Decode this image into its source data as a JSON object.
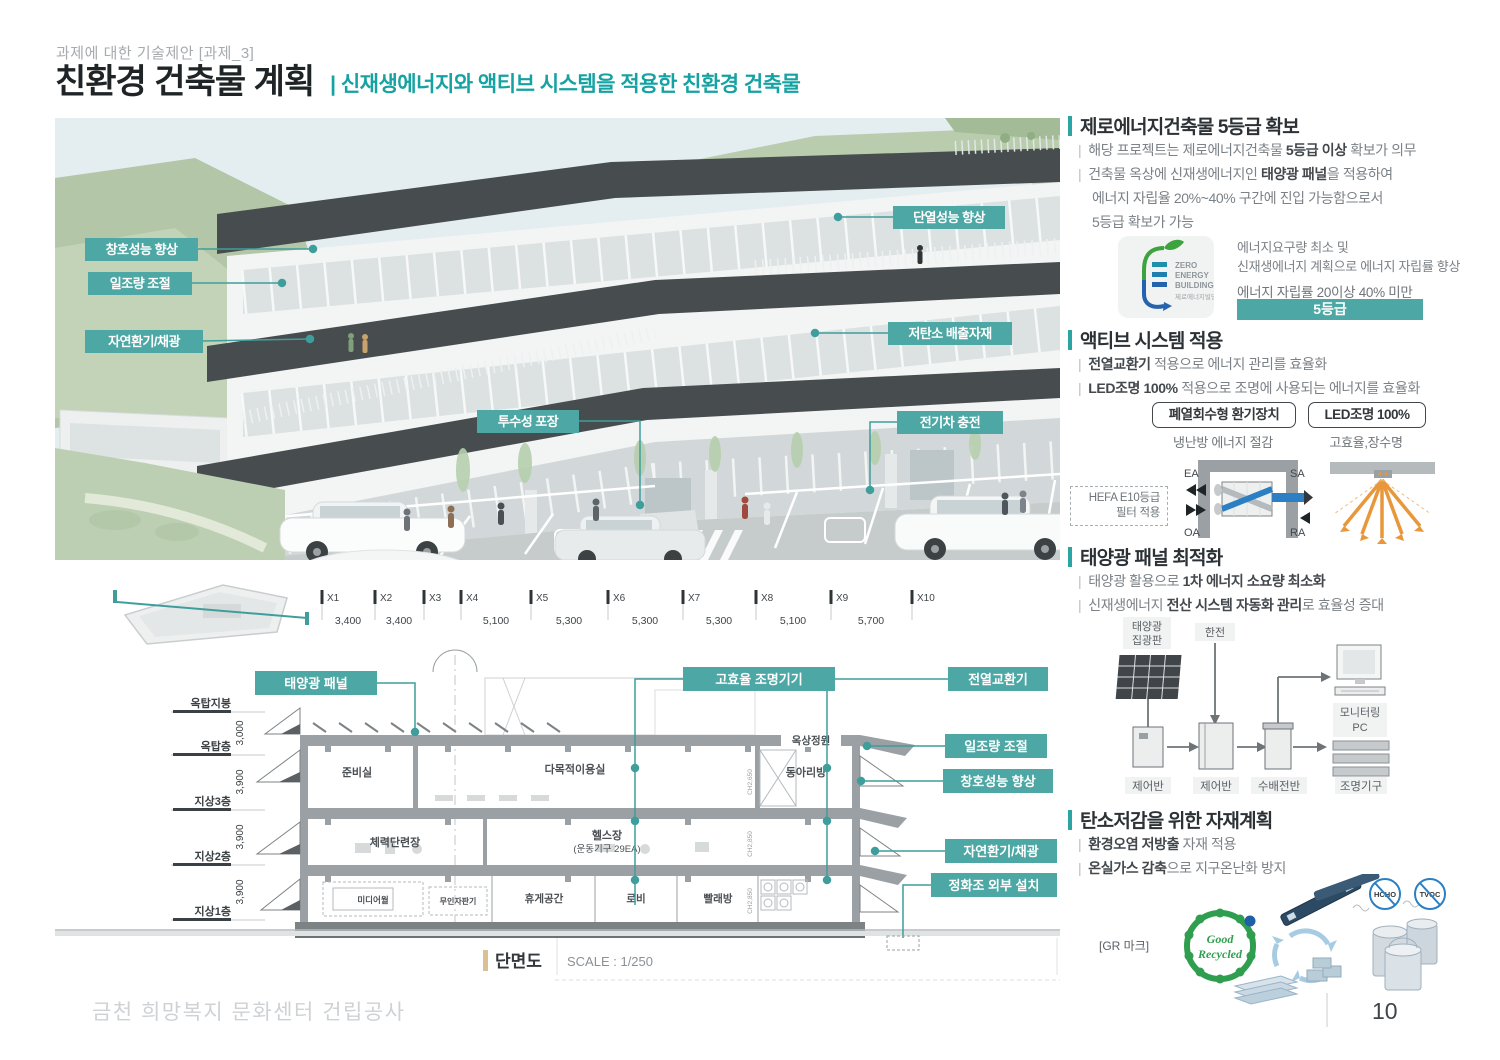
{
  "colors": {
    "accent": "#2ba5a3",
    "callout_fill": "#4da7a4",
    "roof_band": "#474c4f",
    "orange": "#e8973a",
    "blue_pipe": "#2b7fc2",
    "green_seal": "#2f9e4f"
  },
  "header": {
    "eyebrow": "과제에 대한 기술제안 [과제_3]",
    "title": "친환경 건축물 계획",
    "subtitle": "| 신재생에너지와 액티브 시스템을 적용한 친환경 건축물"
  },
  "rendering": {
    "callouts": [
      "창호성능 향상",
      "일조량 조절",
      "자연환기/채광",
      "투수성 포장",
      "단열성능 향상",
      "저탄소 배출자재",
      "전기차 충전"
    ]
  },
  "section": {
    "grid_labels": [
      "X1",
      "X2",
      "X3",
      "X4",
      "X5",
      "X6",
      "X7",
      "X8",
      "X9",
      "X10"
    ],
    "grid_values": [
      "3,400",
      "3,400",
      "5,100",
      "5,300",
      "5,300",
      "5,300",
      "5,100",
      "5,700"
    ],
    "floors": [
      "옥탑지붕",
      "옥탑층",
      "지상3층",
      "지상2층",
      "지상1층"
    ],
    "heights": [
      "3,000",
      "3,900",
      "3,900",
      "3,900"
    ],
    "rooms": {
      "junbisil": "준비실",
      "damokjeok": "다목적이용실",
      "dongari": "동아리방",
      "cheryeok": "체력단련장",
      "helseu": "헬스장",
      "helseu_sub": "(운동기구 29EA)",
      "media": "미디어월",
      "muin": "무인자판기",
      "hyuge": "휴게공간",
      "lobby": "로비",
      "ppallae": "빨래방",
      "roofgarden": "옥상정원"
    },
    "ch": [
      "CH2,650",
      "CH2,850",
      "CH2,850"
    ],
    "callouts": [
      "태양광 패널",
      "고효율 조명기기",
      "전열교환기",
      "일조량 조절",
      "창호성능 향상",
      "자연환기/채광",
      "정화조 외부 설치"
    ],
    "caption": "단면도",
    "scale": "SCALE : 1/250"
  },
  "panel": {
    "pipe": "|",
    "s1": {
      "title": "제로에너지건축물 5등급 확보",
      "b1": {
        "pre": "해당 프로젝트는 제로에너지건축물 ",
        "bold": "5등급 이상",
        "post": " 확보가 의무"
      },
      "b2": {
        "pre": "건축물 옥상에 신재생에너지인 ",
        "bold": "태양광 패널",
        "post": "을 적용하여"
      },
      "b3": "에너지 자립율 20%~40% 구간에 진입 가능함으로서",
      "b4": "5등급 확보가 가능",
      "zeb": {
        "l1": "ZERO",
        "l2": "ENERGY",
        "l3": "BUILDING",
        "l4": "제로에너지빌딩",
        "note1": "에너지요구량 최소 및",
        "note2": "신재생에너지 계획으로 에너지 자립률 향상",
        "range": "에너지 자립률 20이상 40% 미만",
        "grade": "5등급"
      }
    },
    "s2": {
      "title": "액티브 시스템 적용",
      "b1": {
        "pre": "",
        "bold": "전열교환기",
        "post": " 적용으로 에너지 관리를 효율화"
      },
      "b2": {
        "pre": "",
        "bold": "LED조명 100%",
        "post": " 적용으로 조명에 사용되는 에너지를 효율화"
      },
      "box1": "폐열회수형 환기장치",
      "cap1": "냉난방 에너지 절감",
      "box2": "LED조명 100%",
      "cap2": "고효율,장수명",
      "hx": {
        "ea": "EA",
        "sa": "SA",
        "oa": "OA",
        "ra": "RA",
        "filter1": "HEFA E10등급",
        "filter2": "필터 적용"
      }
    },
    "s3": {
      "title": "태양광 패널 최적화",
      "b1": {
        "pre": "태양광 활용으로 ",
        "bold": "1차 에너지 소요량 최소화",
        "post": ""
      },
      "b2": {
        "pre": "신재생에너지 ",
        "bold": "전산 시스템 자동화 관리",
        "post": "로 효율성 증대"
      },
      "diagram": {
        "pv1": "태양광",
        "pv2": "집광판",
        "kepco": "한전",
        "mon1": "모니터링",
        "mon2": "PC",
        "ctrl1": "제어반",
        "ctrl2": "제어반",
        "switch": "수배전반",
        "light": "조명기구"
      }
    },
    "s4": {
      "title": "탄소저감을 위한 자재계획",
      "b1": {
        "pre": "",
        "bold": "환경오염 저방출",
        "post": " 자재 적용"
      },
      "b2": {
        "pre": "",
        "bold": "온실가스 감축",
        "post": "으로 지구온난화 방지"
      },
      "gr": {
        "label": "[GR 마크]",
        "seal1": "Good",
        "seal2": "Recycled",
        "c1": "HCHO",
        "c2": "TVOC"
      }
    }
  },
  "footer": {
    "project": "금천 희망복지 문화센터 건립공사",
    "page": "10"
  }
}
